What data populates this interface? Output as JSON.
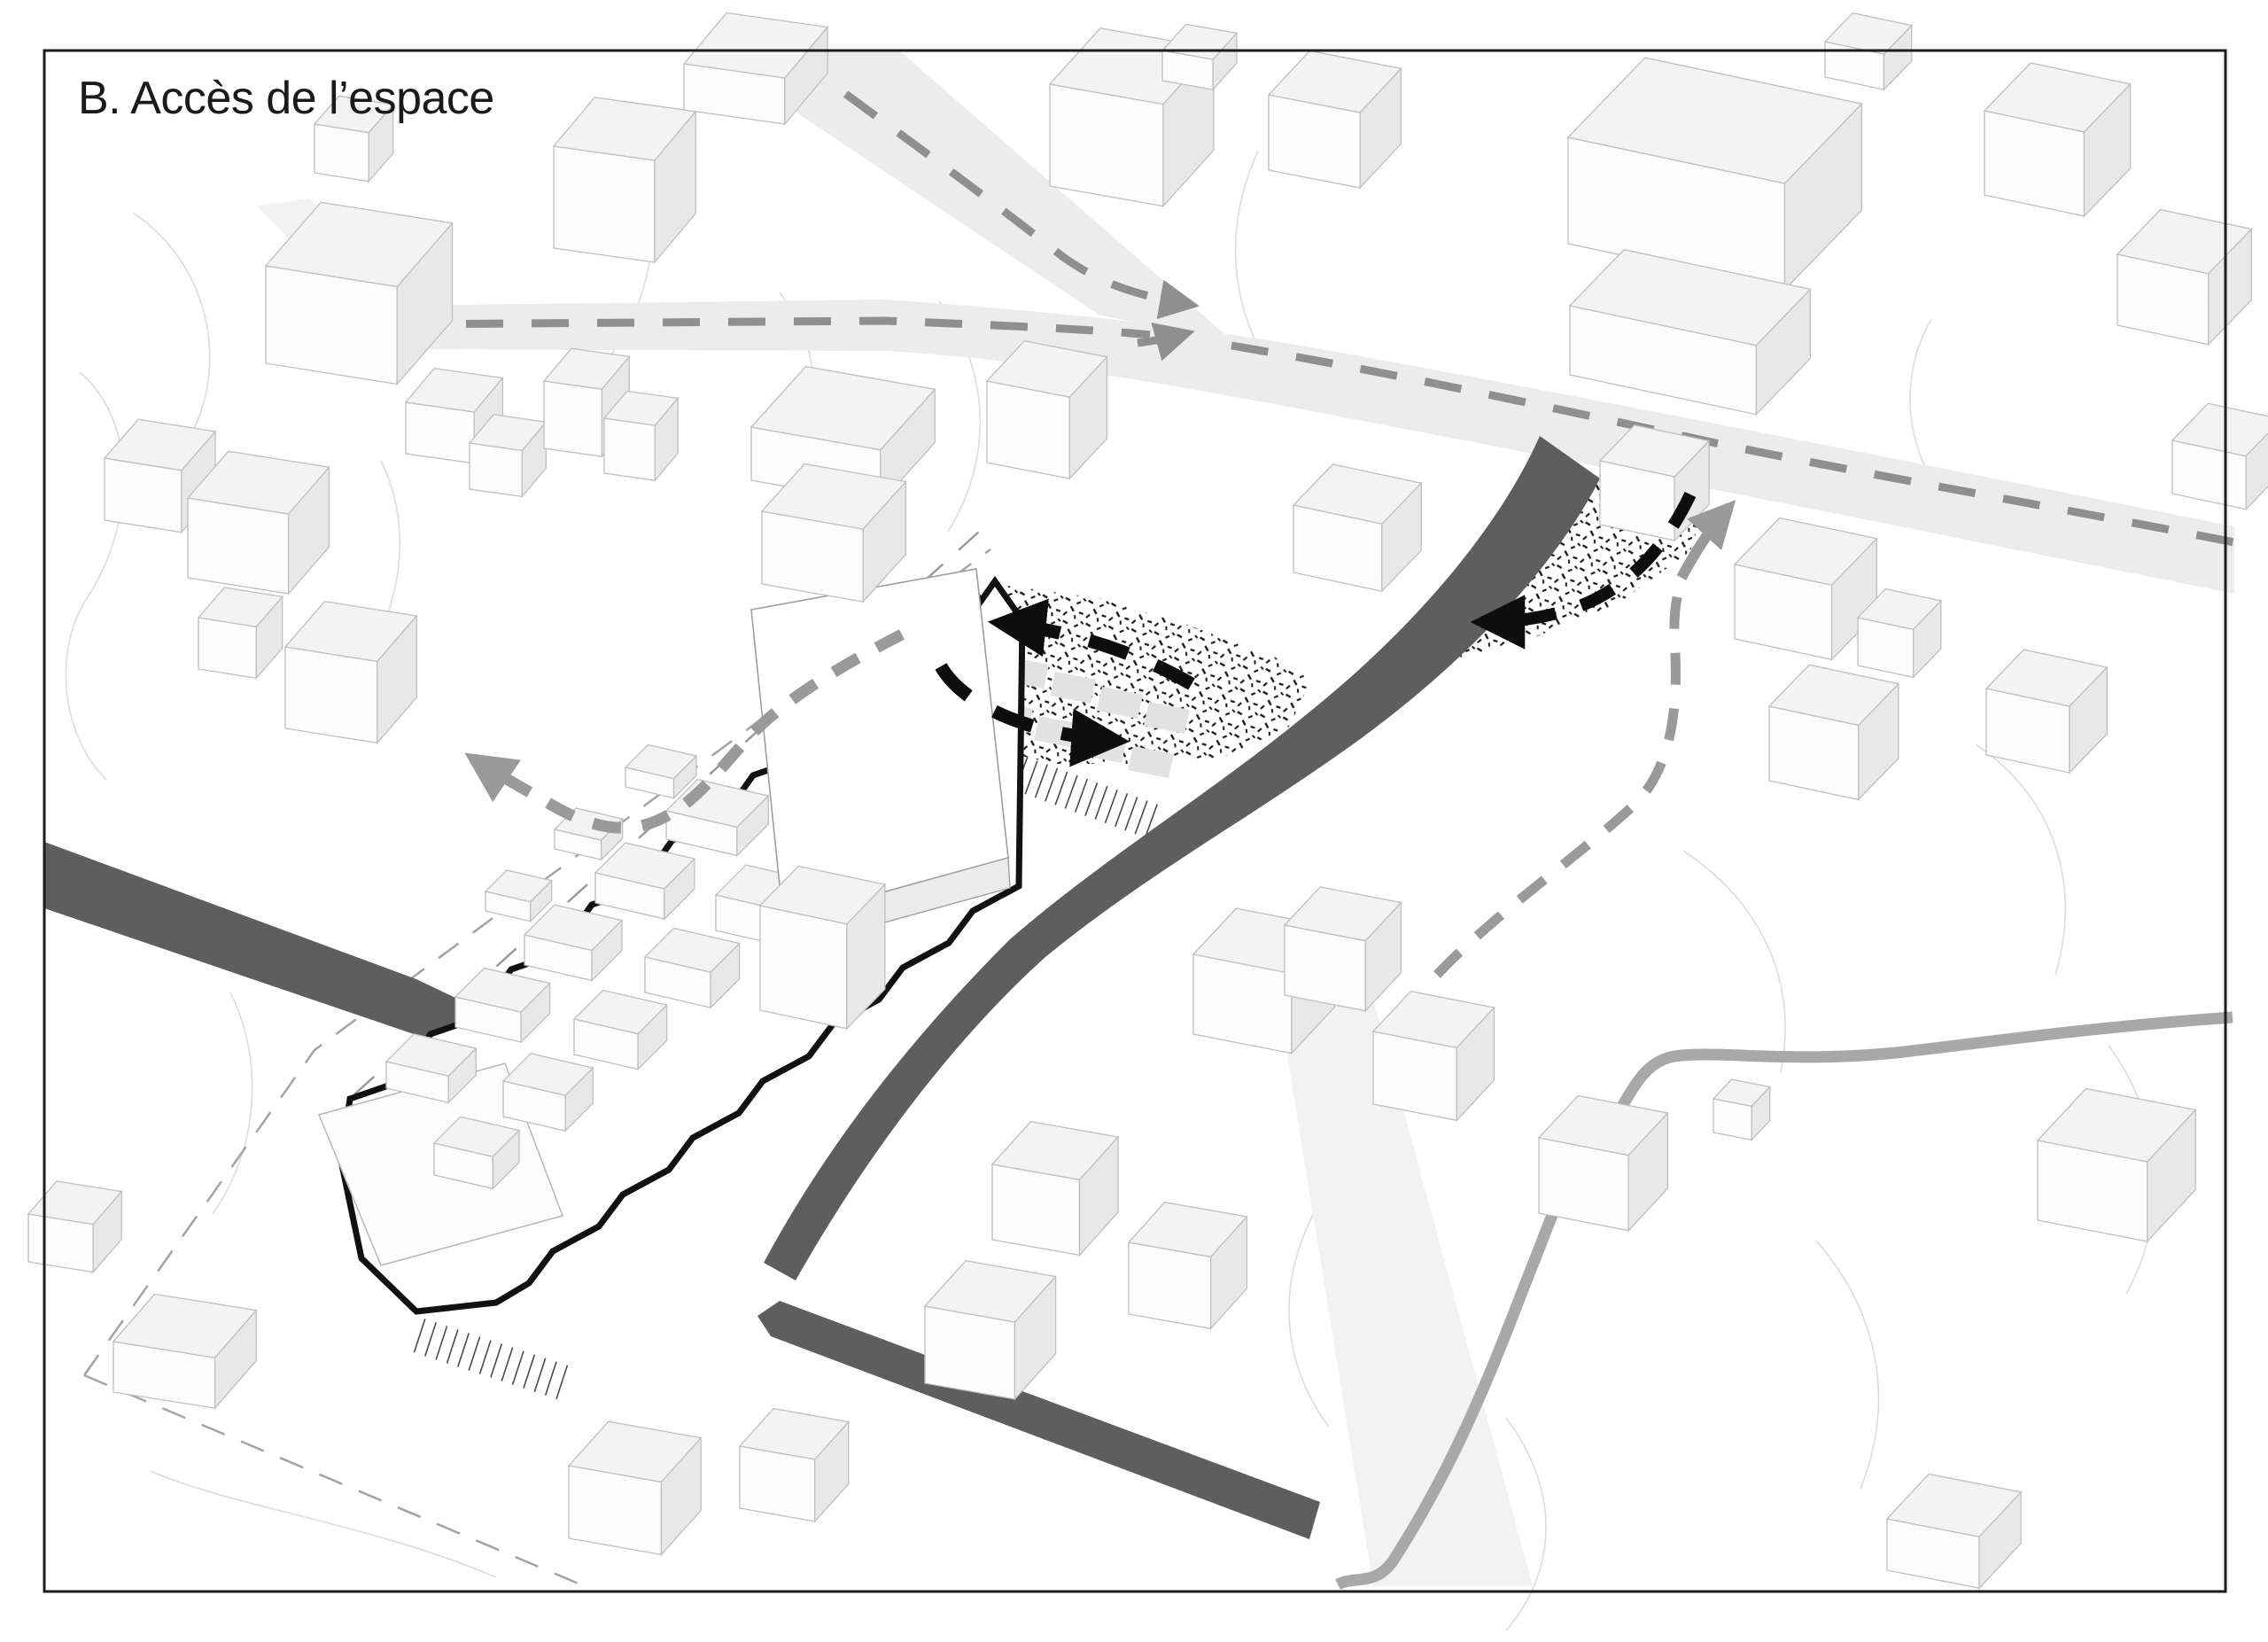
{
  "figure": {
    "title": "B. Accès de l’espace"
  },
  "palette": {
    "paper": "#ffffff",
    "frame": "#1d1d1d",
    "ink": "#1a1a1a",
    "building-roof": "#f3f3f3",
    "building-front": "#fdfdfd",
    "building-side": "#e8e8e8",
    "building-stroke": "#bfbfbf",
    "road-light": "#ececec",
    "road-dark": "#5e5e5e",
    "route-dash": "#8f8f8f",
    "ped-dash": "#9a9a9a",
    "flow-black": "#0d0d0d",
    "river": "#a8a8a8",
    "contour": "#dcdcdc",
    "site-outline": "#111111",
    "boundary-dash": "#a3a3a3"
  },
  "elements": [
    {
      "name": "vehicle-route-dashed",
      "color": "#8f8f8f"
    },
    {
      "name": "site-circulation-loop-dashed",
      "color": "#0d0d0d"
    },
    {
      "name": "pedestrian-access-dashed",
      "color": "#9a9a9a"
    },
    {
      "name": "main-street-dark",
      "color": "#5e5e5e"
    },
    {
      "name": "stippled-plaza-surface",
      "color": "#1a1a1a"
    },
    {
      "name": "project-site-bold-outline",
      "color": "#111111"
    },
    {
      "name": "river-stream",
      "color": "#a8a8a8"
    }
  ]
}
